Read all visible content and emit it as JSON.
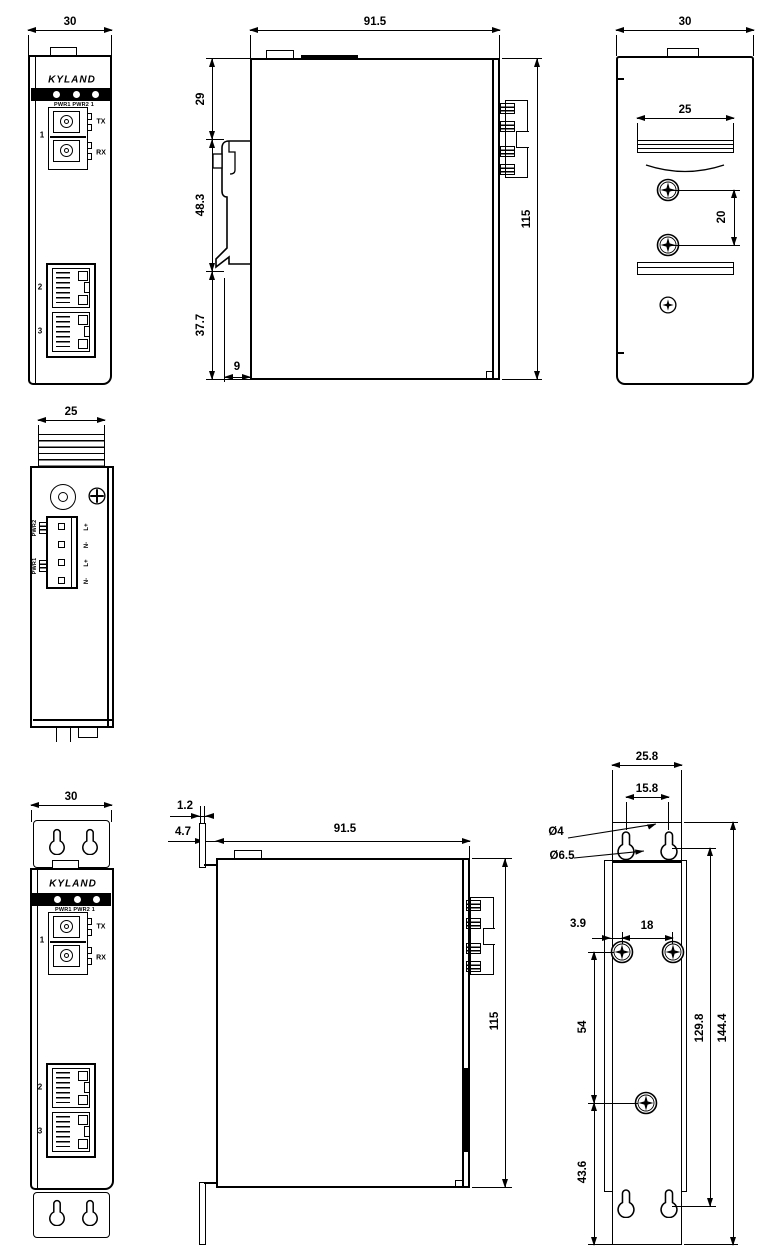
{
  "brand": "KYLAND",
  "led_row": "PWR1 PWR2  1",
  "ports": {
    "p1": "1",
    "tx": "TX",
    "rx": "RX",
    "p2": "2",
    "p3": "3"
  },
  "top_view": {
    "dim_width": "25",
    "pwr2": "PWR2",
    "pwr1": "PWR1",
    "pins": [
      "L+",
      "N-",
      "L+",
      "N-"
    ]
  },
  "din": {
    "front": {
      "dim_width": "30"
    },
    "side": {
      "dim_width": "91.5",
      "dim_top": "29",
      "dim_clip": "48.3",
      "dim_bottom": "37.7",
      "dim_depth": "9",
      "dim_height": "115"
    },
    "back": {
      "dim_width": "30",
      "dim_rail": "25",
      "dim_screw_gap": "20"
    }
  },
  "wall": {
    "front": {
      "dim_width": "30"
    },
    "side": {
      "dim_plate": "1.2",
      "dim_gap": "4.7",
      "dim_width": "91.5",
      "dim_height": "115"
    },
    "back": {
      "dim_plate_width": "25.8",
      "dim_slot_gap": "15.8",
      "dim_hole1": "Ø4",
      "dim_hole2": "Ø6.5",
      "dim_edge": "3.9",
      "dim_screw_gap": "18",
      "dim_mid": "54",
      "dim_bottom": "43.6",
      "dim_keyhole_span": "129.8",
      "dim_total": "144.4"
    }
  }
}
